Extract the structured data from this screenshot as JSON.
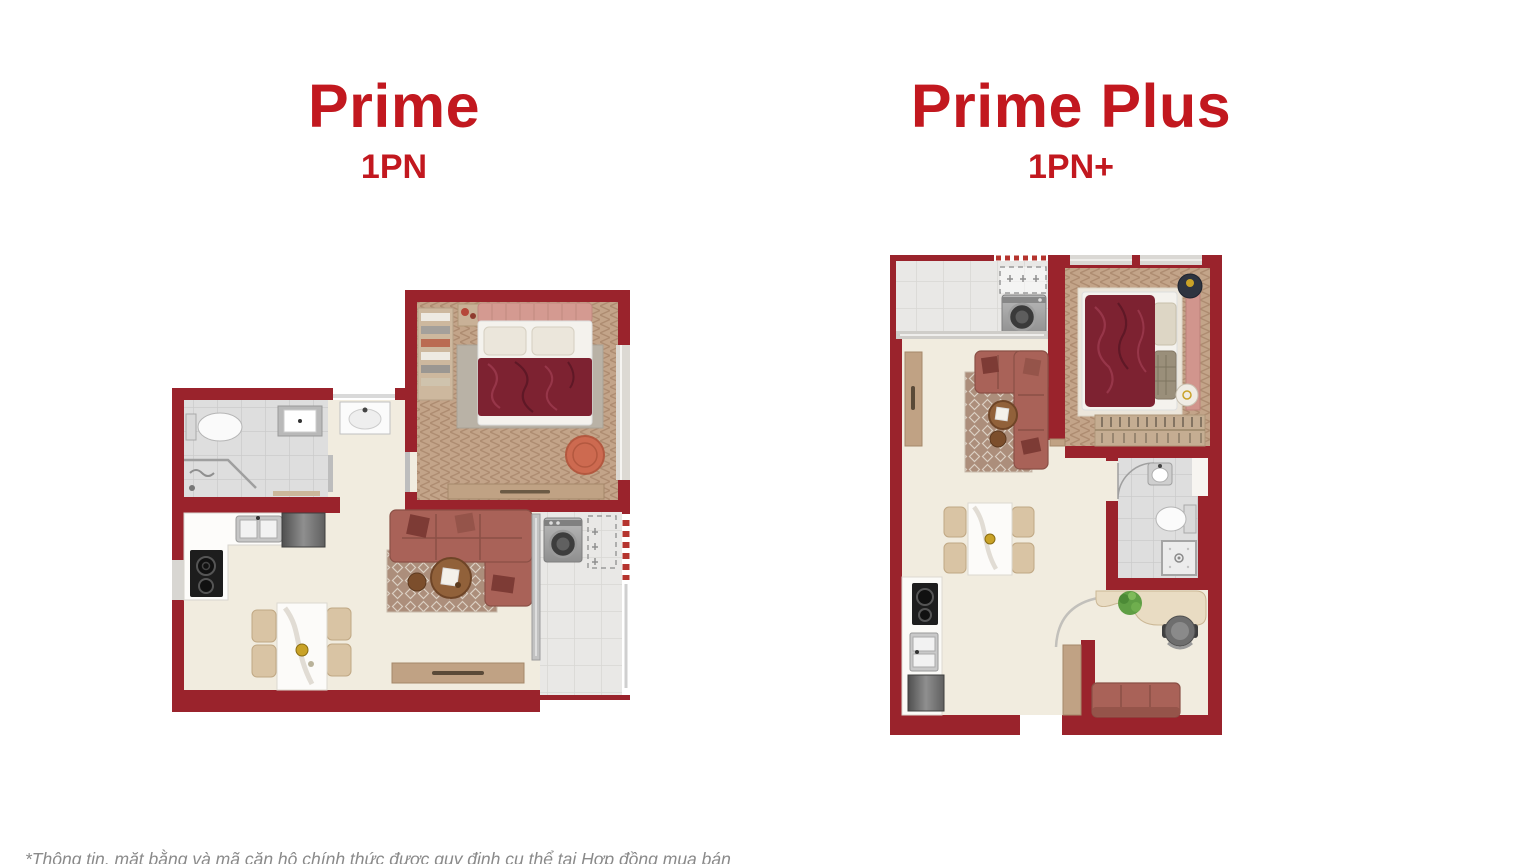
{
  "slide": {
    "background": "#ffffff"
  },
  "plans": [
    {
      "title": "Prime",
      "subtitle": "1PN",
      "rooms": [
        "bedroom",
        "bathroom",
        "kitchen",
        "dining",
        "living",
        "balcony"
      ],
      "furniture": [
        "double-bed",
        "wardrobe",
        "toilet",
        "washbasin",
        "shower",
        "cooktop",
        "kitchen-sink",
        "fridge",
        "dining-table-4-chairs",
        "l-shaped-sofa",
        "coffee-table",
        "tv-console",
        "washing-machine",
        "ac-unit-dashed",
        "pouf"
      ]
    },
    {
      "title": "Prime Plus",
      "subtitle": "1PN+",
      "rooms": [
        "balcony",
        "bedroom",
        "living",
        "dining",
        "kitchen",
        "bathroom",
        "study"
      ],
      "furniture": [
        "washing-machine",
        "ac-unit-dashed",
        "double-bed",
        "wardrobe",
        "nightstands",
        "l-shaped-sofa",
        "coffee-table",
        "tv-console",
        "dining-table-4-chairs",
        "cooktop",
        "kitchen-sink",
        "fridge",
        "toilet",
        "washbasin",
        "shower",
        "desk",
        "office-chair",
        "plant",
        "sofa-2-seat"
      ]
    }
  ],
  "footnote": "*Thông tin, mặt bằng và mã căn hộ chính thức được quy định cụ thể tại Hợp đồng mua bán",
  "colors": {
    "title_red": "#c2181f",
    "wall_red": "#9a232c",
    "floor_cream": "#f1ecdf",
    "wood_floor": "#c3a489",
    "tile_gray": "#dedede",
    "sofa_mauve": "#a96258",
    "blanket_red": "#7d2231",
    "accent_dot_red": "#b5342e"
  }
}
